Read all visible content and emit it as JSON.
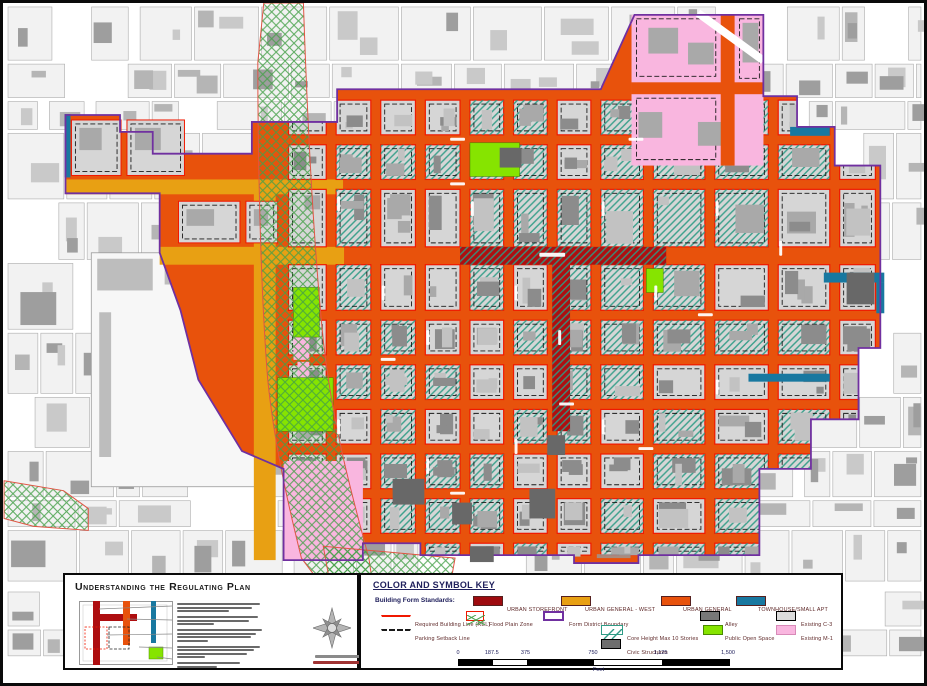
{
  "panel_understanding": {
    "title": "Understanding the Regulating Plan",
    "paragraph_line_widths": [
      [
        90,
        82,
        56
      ],
      [
        88,
        78,
        40
      ],
      [
        92,
        86,
        80,
        34
      ],
      [
        90,
        84,
        76,
        30
      ],
      [
        68,
        44
      ]
    ]
  },
  "panel_key": {
    "title": "COLOR AND SYMBOL KEY",
    "building_form_label": "Building Form Standards:",
    "form_standards": [
      {
        "label": "URBAN STOREFRONT",
        "color": "#9e0b0f",
        "x": 112,
        "lx": 146
      },
      {
        "label": "URBAN GENERAL - WEST",
        "color": "#e8a013",
        "x": 200,
        "lx": 224
      },
      {
        "label": "URBAN GENERAL",
        "color": "#e8520c",
        "x": 300,
        "lx": 322
      },
      {
        "label": "TOWNHOUSE/SMALL APT",
        "color": "#1878a0",
        "x": 375,
        "lx": 397
      }
    ],
    "symbol_rows": [
      {
        "y": 36,
        "items": [
          {
            "type": "line-red",
            "label": "Required Building Line (RBL)",
            "x": 20,
            "lx": 54
          },
          {
            "type": "swatch-flood",
            "label": "Flood Plain Zone",
            "x": 105,
            "lx": 128
          },
          {
            "type": "swatch-outline",
            "label": "Form District Boundary",
            "x": 182,
            "lx": 208,
            "border": "#7030a0"
          },
          {
            "type": "swatch-fill",
            "label": "Alley",
            "x": 339,
            "lx": 364,
            "color": "#787878",
            "border": "#000000"
          },
          {
            "type": "swatch-fill",
            "label": "Existing C-3",
            "x": 415,
            "lx": 440,
            "color": "#dcdcdc",
            "border": "#000000"
          }
        ]
      },
      {
        "y": 50,
        "items": [
          {
            "type": "line-dashed",
            "label": "Parking Setback Line",
            "x": 20,
            "lx": 54
          },
          {
            "type": "swatch-teal-diag",
            "label": "Core Height Max 10 Stories",
            "x": 240,
            "lx": 266
          },
          {
            "type": "swatch-fill",
            "label": "Public Open Space",
            "x": 342,
            "lx": 364,
            "color": "#86e400",
            "border": "#4a8a00"
          },
          {
            "type": "swatch-fill",
            "label": "Existing M-1",
            "x": 415,
            "lx": 440,
            "color": "#f9b6df",
            "border": "#d88ab8"
          }
        ]
      },
      {
        "y": 64,
        "items": [
          {
            "type": "swatch-fill",
            "label": "Civic Structures",
            "x": 240,
            "lx": 266,
            "color": "#6e6e6e",
            "border": "#000000"
          }
        ]
      }
    ]
  },
  "scale_bar": {
    "ticks": [
      {
        "label": "0",
        "f": 0
      },
      {
        "label": "187.5",
        "f": 0.125
      },
      {
        "label": "375",
        "f": 0.25
      },
      {
        "label": "750",
        "f": 0.5
      },
      {
        "label": "1,125",
        "f": 0.75
      },
      {
        "label": "1,500",
        "f": 1
      }
    ],
    "unit": "Feet"
  },
  "map": {
    "palette": {
      "orange": "#e8520c",
      "gold": "#e8a013",
      "darkred": "#ae0e10",
      "rbl_red": "#f01800",
      "teal_hatch": "#2e9b85",
      "townhouse": "#1878a0",
      "purple": "#7030a0",
      "pink": "#f9b6df",
      "open_green": "#86e400",
      "flood_green": "#44a048",
      "block_gray": "#d6d6d6",
      "building_gray": "#a9a9a9",
      "building_dark": "#8c8c8c",
      "civic": "#686868",
      "parcel": "#f2f2f2",
      "parcel_line": "#ababab"
    },
    "district_path": "M62,113 H117 V130 H150 V152 H250 V120 H336 V87 H602 L636,12 H766 V94 H800 V125 H838 V164 H884 V348 H862 V420 H814 V470 H762 V557 H640 V565 H575 V557 H420 V545 H362 V562 H282 V470 L240,452 L196,380 L178,310 L157,252 L157,192 H62 Z",
    "flood_paths": [
      "M262,0 H302 C306,120 312,240 322,340 C332,430 352,500 368,560 L374,600 L330,600 L300,560 C285,500 272,440 266,380 C258,280 256,140 256,60 Z",
      "M0,482 L60,492 L85,510 L85,532 L30,528 L0,520 Z",
      "M322,548 L455,560 L450,588 L330,592 Z"
    ],
    "col_edges": [
      282,
      330,
      375,
      420,
      465,
      509,
      553,
      597,
      650,
      712,
      776,
      838,
      884
    ],
    "row_edges": [
      88,
      133,
      178,
      246,
      310,
      355,
      400,
      445,
      490,
      535,
      557
    ],
    "row_street_h": [
      10,
      10,
      10,
      18,
      10,
      10,
      10,
      10,
      10,
      10
    ],
    "gold_rects": [
      [
        62,
        178,
        280,
        15
      ],
      [
        252,
        178,
        22,
        384
      ],
      [
        157,
        246,
        186,
        18
      ]
    ],
    "storefront_h": [
      460,
      246,
      208,
      18
    ],
    "storefront_v": [
      553,
      246,
      18,
      186
    ],
    "pink_top": [
      633,
      12,
      133,
      152
    ],
    "pink_top_streets": {
      "h": [
        633,
        80,
        133,
        12
      ],
      "v": [
        723,
        12,
        14,
        152
      ],
      "diag": [
        [
          700,
          10
        ],
        [
          766,
          58
        ]
      ]
    },
    "pink_top_buildings": [
      [
        650,
        25,
        30,
        26
      ],
      [
        690,
        40,
        26,
        22
      ],
      [
        640,
        110,
        24,
        26
      ],
      [
        700,
        120,
        30,
        24
      ],
      [
        745,
        20,
        16,
        40
      ]
    ],
    "pink_top_dashed": [
      [
        638,
        16,
        80,
        58
      ],
      [
        638,
        96,
        80,
        62
      ],
      [
        742,
        16,
        20,
        60
      ]
    ],
    "pink_rects": [
      [
        282,
        462,
        80,
        100
      ],
      [
        292,
        330,
        16,
        30
      ],
      [
        296,
        362,
        12,
        20
      ],
      [
        746,
        95,
        20,
        62
      ]
    ],
    "green_rects": [
      [
        470,
        141,
        50,
        34
      ],
      [
        292,
        287,
        26,
        50
      ],
      [
        276,
        378,
        56,
        54
      ],
      [
        648,
        268,
        17,
        24
      ]
    ],
    "teal_strips": [
      [
        61,
        112,
        6,
        64
      ],
      [
        827,
        272,
        61,
        10
      ],
      [
        880,
        282,
        8,
        31
      ],
      [
        751,
        374,
        82,
        8
      ],
      [
        793,
        125,
        40,
        9
      ]
    ],
    "civic_buildings": [
      [
        392,
        480,
        32,
        26
      ],
      [
        452,
        504,
        20,
        22
      ],
      [
        530,
        490,
        26,
        30
      ],
      [
        548,
        436,
        18,
        20
      ],
      [
        470,
        548,
        24,
        16
      ],
      [
        500,
        146,
        22,
        20
      ],
      [
        850,
        272,
        28,
        32
      ]
    ],
    "white_area": {
      "rect": [
        88,
        252,
        180,
        236
      ],
      "buildings": [
        [
          94,
          258,
          56,
          32
        ],
        [
          162,
          258,
          36,
          26
        ],
        [
          206,
          300,
          52,
          58
        ],
        [
          96,
          312,
          12,
          146
        ]
      ]
    },
    "arm_blocks": [
      [
        68,
        118,
        50,
        56
      ],
      [
        124,
        118,
        58,
        56
      ],
      [
        176,
        200,
        62,
        42
      ],
      [
        244,
        200,
        32,
        42
      ]
    ],
    "street_marks_v": [
      [
        336,
        195
      ],
      [
        381,
        285
      ],
      [
        426,
        330
      ],
      [
        471,
        200
      ],
      [
        515,
        285
      ],
      [
        559,
        330
      ],
      [
        603,
        200
      ],
      [
        656,
        285
      ],
      [
        718,
        200
      ],
      [
        782,
        240
      ],
      [
        336,
        420
      ],
      [
        426,
        460
      ],
      [
        515,
        440
      ],
      [
        603,
        420
      ],
      [
        718,
        380
      ]
    ],
    "street_marks_h": [
      [
        450,
        136
      ],
      [
        630,
        136
      ],
      [
        450,
        181
      ],
      [
        700,
        313
      ],
      [
        380,
        358
      ],
      [
        560,
        403
      ],
      [
        640,
        448
      ],
      [
        450,
        493
      ]
    ],
    "band_mark": [
      540,
      252,
      26,
      4
    ],
    "small_label_bar": [
      598,
      556,
      34,
      4
    ]
  }
}
